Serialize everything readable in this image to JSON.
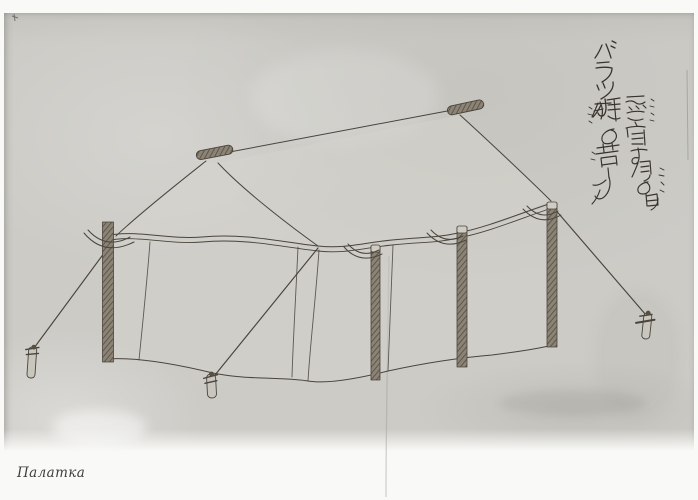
{
  "page": {
    "caption": "Палатка",
    "annotation": {
      "katakana_title": "バラツカ",
      "line1": "露宿する時の白木",
      "line2": "綿の幕なり",
      "furigana1": "ろしゆく",
      "furigana2": "もめん"
    },
    "colors": {
      "paper": "#cccbc6",
      "margin": "#f9f9f7",
      "ink": "#4a443c",
      "calligraphy_ink": "#38342c",
      "caption_ink": "#3e3e3e"
    }
  }
}
